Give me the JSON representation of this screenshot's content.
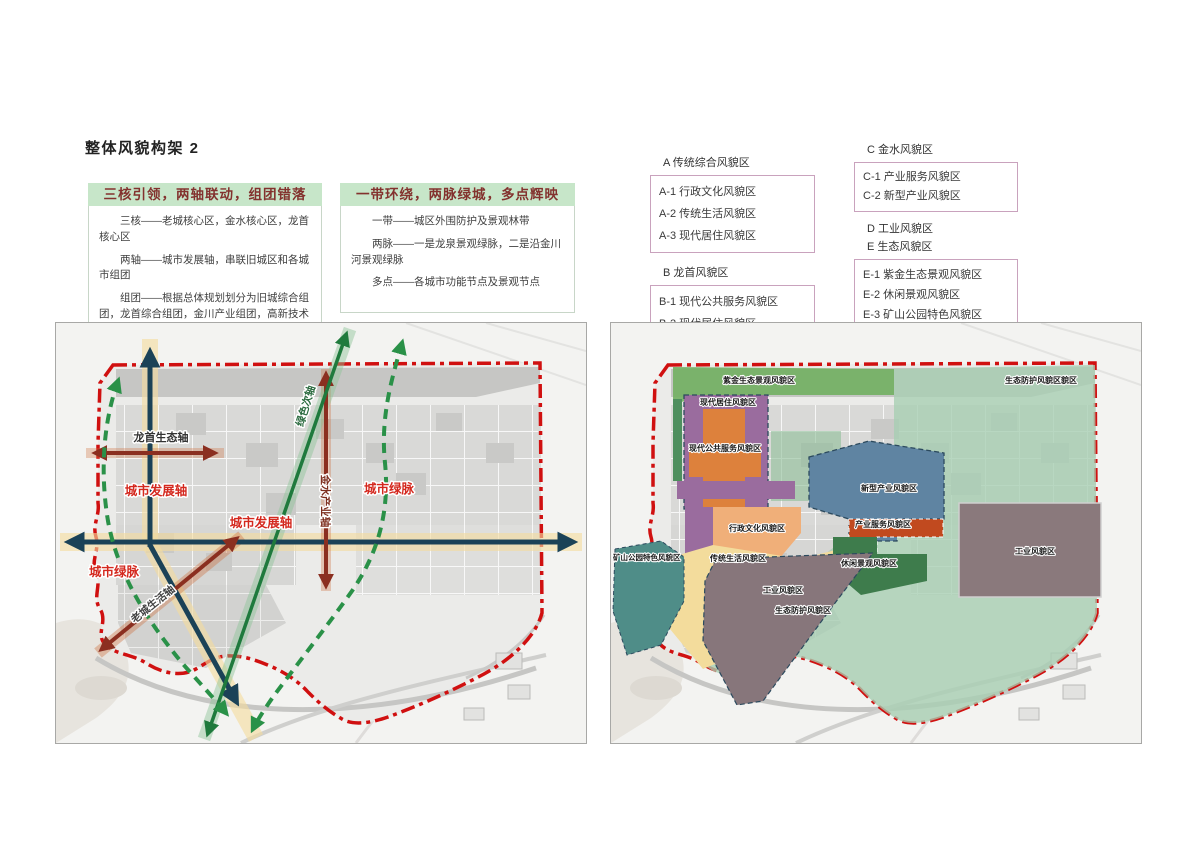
{
  "page": {
    "title": "整体风貌构架 2"
  },
  "concept_boxes": [
    {
      "header": "三核引领，两轴联动，组团错落",
      "lines": [
        "三核——老城核心区，金水核心区，龙首核心区",
        "两轴——城市发展轴，串联旧城区和各城市组团",
        "组团——根据总体规划划分为旧城综合组团，龙首综合组团，金川产业组团，高新技术产业组团，新材料工业组团"
      ]
    },
    {
      "header": "一带环绕，两脉绿城，多点辉映",
      "lines": [
        "一带——城区外围防护及景观林带",
        "两脉——一是龙泉景观绿脉，二是沿金川河景观绿脉",
        "多点——各城市功能节点及景观节点"
      ]
    }
  ],
  "legend": {
    "groups": [
      {
        "title": "A 传统综合风貌区",
        "items": [
          "A-1 行政文化风貌区",
          "A-2 传统生活风貌区",
          "A-3 现代居住风貌区"
        ]
      },
      {
        "title": "B 龙首风貌区",
        "items": [
          "B-1 现代公共服务风貌区",
          "B-2 现代居住风貌区"
        ]
      },
      {
        "title": "C 金水风貌区",
        "items": [
          "C-1 产业服务风貌区",
          "C-2 新型产业风貌区"
        ]
      },
      {
        "title": "D 工业风貌区",
        "items": []
      },
      {
        "title": "E 生态风貌区",
        "items": [
          "E-1 紫金生态景观风貌区",
          "E-2 休闲景观风貌区",
          "E-3 矿山公园特色风貌区",
          "E-4 生态防护风貌区"
        ]
      }
    ]
  },
  "left_map": {
    "labels": {
      "longshou_axis": "龙首生态轴",
      "city_dev_axis_v": "城市发展轴",
      "city_dev_axis_h": "城市发展轴",
      "green_secondary": "绿色次轴",
      "jinshui_axis": "金水产业轴",
      "green_vein_e": "城市绿脉",
      "green_vein_w": "城市绿脉",
      "oldtown_axis": "老城生活轴"
    }
  },
  "right_map": {
    "labels": {
      "zijin_band": "紫金生态景观风貌区",
      "eco_top": "生态防护风貌区貌区",
      "modern_residence": "现代居住风貌区",
      "modern_public": "现代公共服务风貌区",
      "new_industry": "新型产业风貌区",
      "industry_service": "产业服务风貌区",
      "admin_culture": "行政文化风貌区",
      "trad_life": "传统生活风貌区",
      "leisure": "休闲景观风貌区",
      "industry_right": "工业风貌区",
      "industry_diag": "工业风貌区",
      "mining_park": "矿山公园特色风貌区",
      "eco_bottom": "生态防护风貌区"
    }
  },
  "colors": {
    "header_green": "#c7e6c9",
    "header_text": "#83322e",
    "legend_border": "#c9a2bd",
    "boundary_red": "#d01010",
    "axis_navy": "#1b4257",
    "axis_cream": "#f4db9e",
    "axis_red": "#8b2f20",
    "axis_green": "#1f7a3d",
    "green_dashed": "#2a9148",
    "map_label_red": "#d4281e",
    "zone_purple": "#9a6c9e",
    "zone_orange": "#dd813c",
    "zone_peach": "#f0af79",
    "zone_yellow": "#f3dc9c",
    "zone_blue": "#5f84a2",
    "zone_red": "#c14a1f",
    "zone_darkgreen": "#3e7c4c",
    "zone_teal": "#4f8d88",
    "zone_industry": "#8a797c",
    "zone_mint": "#a7ceb2",
    "zone_band_green": "#73b063"
  }
}
